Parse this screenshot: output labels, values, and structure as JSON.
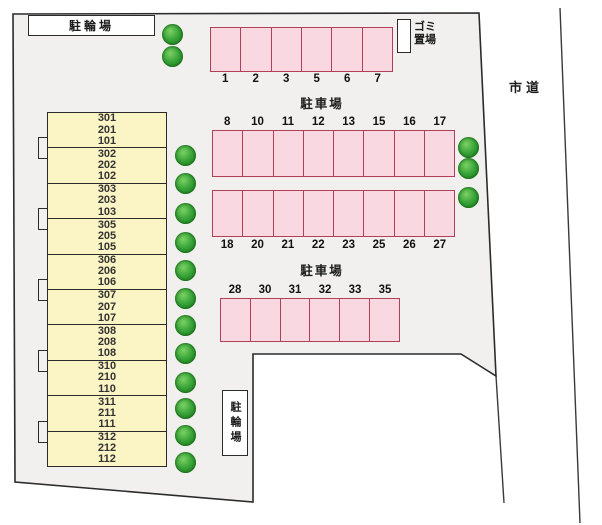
{
  "labels": {
    "bicycle_parking_top": "駐輪場",
    "bicycle_parking_bottom": "駐輪場",
    "garbage_area": [
      "ゴミ",
      "置場"
    ],
    "city_road": "市道",
    "parking_lot_upper": "駐車場",
    "parking_lot_lower": "駐車場"
  },
  "parking_rows": [
    {
      "name": "row-1",
      "numbers_position": "below",
      "numbers": [
        "1",
        "2",
        "3",
        "5",
        "6",
        "7"
      ]
    },
    {
      "name": "row-2",
      "numbers_position": "above",
      "numbers": [
        "8",
        "10",
        "11",
        "12",
        "13",
        "15",
        "16",
        "17"
      ]
    },
    {
      "name": "row-3",
      "numbers_position": "below",
      "numbers": [
        "18",
        "20",
        "21",
        "22",
        "23",
        "25",
        "26",
        "27"
      ]
    },
    {
      "name": "row-4",
      "numbers_position": "above",
      "numbers": [
        "28",
        "30",
        "31",
        "32",
        "33",
        "35"
      ]
    }
  ],
  "building": {
    "units": [
      [
        "301",
        "201",
        "101"
      ],
      [
        "302",
        "202",
        "102"
      ],
      [
        "303",
        "203",
        "103"
      ],
      [
        "305",
        "205",
        "105"
      ],
      [
        "306",
        "206",
        "106"
      ],
      [
        "307",
        "207",
        "107"
      ],
      [
        "308",
        "208",
        "108"
      ],
      [
        "310",
        "210",
        "110"
      ],
      [
        "311",
        "211",
        "111"
      ],
      [
        "312",
        "212",
        "112"
      ]
    ]
  },
  "trees": {
    "top": [
      [
        172,
        34
      ],
      [
        172,
        56
      ]
    ],
    "left_column": [
      [
        185,
        155
      ],
      [
        185,
        183
      ],
      [
        185,
        213
      ],
      [
        185,
        242
      ],
      [
        185,
        270
      ],
      [
        185,
        298
      ],
      [
        185,
        325
      ],
      [
        185,
        353
      ],
      [
        185,
        382
      ],
      [
        185,
        408
      ],
      [
        185,
        435
      ],
      [
        185,
        462
      ]
    ],
    "right_column": [
      [
        468,
        147
      ],
      [
        468,
        168
      ],
      [
        468,
        197
      ]
    ]
  },
  "colors": {
    "property_fill": "#f1f0ef",
    "outline": "#2b2b2b",
    "parking_fill": "#f9d8e2",
    "parking_border": "#b04058",
    "building_fill": "#fbf4c4",
    "tree_green": "#2f9e2f"
  }
}
